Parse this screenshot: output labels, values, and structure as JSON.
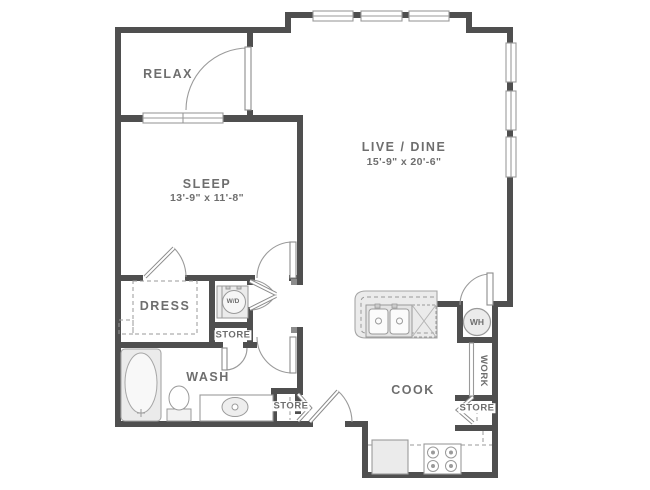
{
  "title": "One-bedroom apartment floor plan",
  "colors": {
    "wall": "#4f4f4f",
    "line": "#9a9a9a",
    "text": "#6e6e6e",
    "fixture_fill": "#ebebeb"
  },
  "rooms": [
    {
      "id": "relax",
      "name": "RELAX",
      "dims": ""
    },
    {
      "id": "sleep",
      "name": "SLEEP",
      "dims": "13'-9\" x 11'-8\""
    },
    {
      "id": "live_dine",
      "name": "LIVE / DINE",
      "dims": "15'-9\" x 20'-6\""
    },
    {
      "id": "dress",
      "name": "DRESS",
      "dims": ""
    },
    {
      "id": "wash",
      "name": "WASH",
      "dims": ""
    },
    {
      "id": "cook",
      "name": "COOK",
      "dims": ""
    },
    {
      "id": "work",
      "name": "WORK",
      "dims": ""
    }
  ],
  "closets": {
    "hall": "STORE",
    "entry": "STORE",
    "kitchen": "STORE"
  },
  "appliances": {
    "washer_dryer": "W/D",
    "water_heater": "WH"
  }
}
